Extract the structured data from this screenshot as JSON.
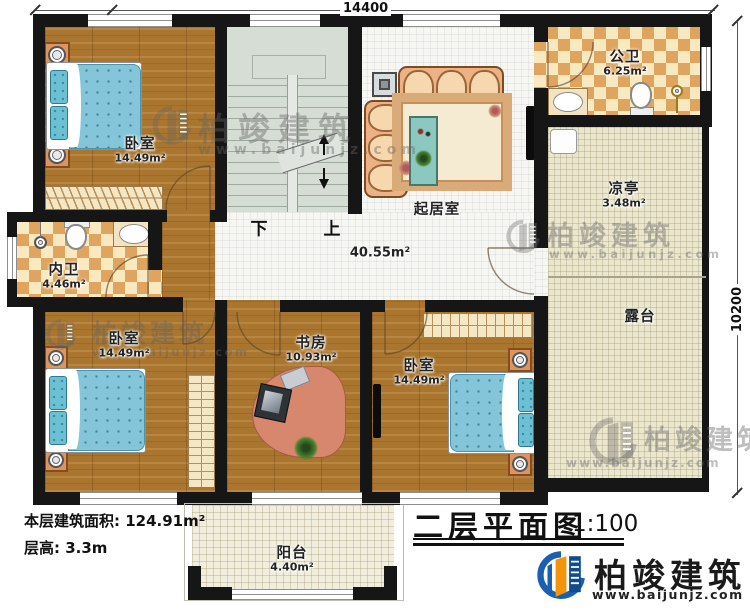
{
  "dimensions": {
    "width": "14400",
    "height": "10200"
  },
  "rooms": [
    {
      "name": "卧室",
      "area": "14.49m²"
    },
    {
      "name": "公卫",
      "area": "6.25m²"
    },
    {
      "name": "凉亭",
      "area": "3.48m²"
    },
    {
      "name": "起居室",
      "area": "40.55m²"
    },
    {
      "name": "内卫",
      "area": "4.46m²"
    },
    {
      "name": "卧室",
      "area": "14.49m²"
    },
    {
      "name": "书房",
      "area": "10.93m²"
    },
    {
      "name": "卧室",
      "area": "14.49m²"
    },
    {
      "name": "露台",
      "area": ""
    },
    {
      "name": "阳台",
      "area": "4.40m²"
    }
  ],
  "stairs": {
    "down": "下",
    "up": "上"
  },
  "footer": {
    "building_area": "本层建筑面积: 124.91m²",
    "floor_height": "层高: 3.3m"
  },
  "title_block": {
    "title": "二层平面图",
    "scale": "1:100"
  },
  "brand": {
    "name": "柏竣建筑",
    "website": "www.baijunjz.com"
  },
  "watermark": {
    "name": "柏竣建筑",
    "website": "www.baijunjz.com"
  },
  "colors": {
    "wall": "#161616",
    "wood_floor": "#a9752f",
    "tile_floor": "#f6f6f3",
    "bath_tile_dark": "#dfa55e",
    "bath_tile_light": "#f8e9c0",
    "terrace_floor": "#ebe7cf",
    "stair_floor": "#d6ddd5",
    "bed_blue": "#84c5da",
    "sofa_tan": "#ecb286",
    "desk_salmon": "#d8876f",
    "logo_blue": "#1b5fb0",
    "logo_orange": "#f5940a"
  }
}
